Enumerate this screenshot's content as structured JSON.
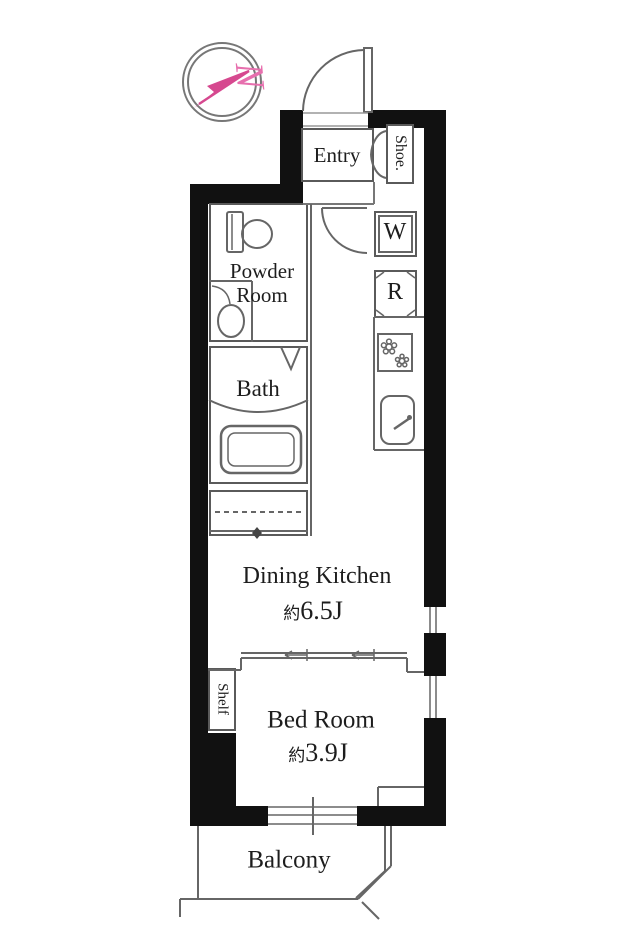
{
  "compass": {
    "north_label": "N"
  },
  "rooms": {
    "entry": "Entry",
    "shoe_closet": "Shoe.",
    "powder_room": "Powder Room",
    "bath": "Bath",
    "washer": "W",
    "refrigerator": "R",
    "dining_kitchen": {
      "name": "Dining Kitchen",
      "area_prefix": "約",
      "area": "6.5J"
    },
    "shelf": "Shelf",
    "bed_room": {
      "name": "Bed Room",
      "area_prefix": "約",
      "area": "3.9J"
    },
    "balcony": "Balcony"
  },
  "colors": {
    "wall": "#111111",
    "line": "#666666",
    "text": "#1d1d1d",
    "compass_arrow": "#d6488f",
    "compass_letter": "#e76fae"
  }
}
